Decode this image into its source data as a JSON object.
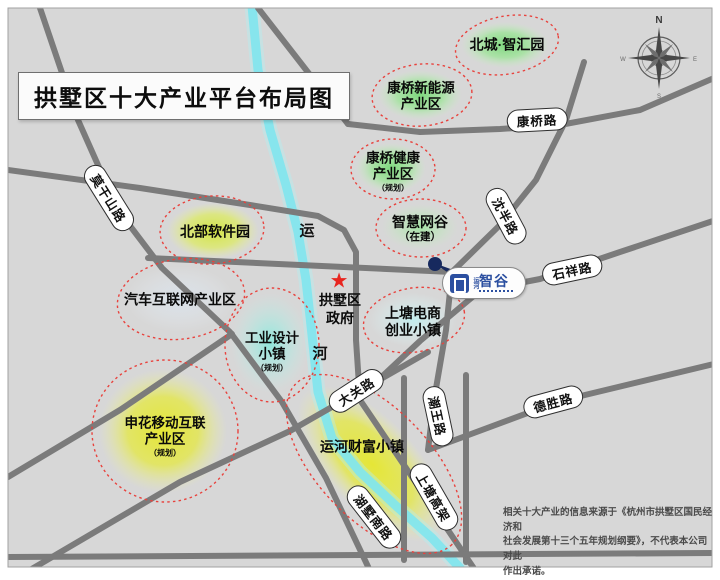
{
  "title": "拱墅区十大产业平台布局图",
  "zones": [
    {
      "id": "beicheng",
      "label": "北城·智汇园"
    },
    {
      "id": "kangqiao_energy",
      "line1": "康桥新能源",
      "line2": "产业区"
    },
    {
      "id": "kangqiao_health",
      "line1": "康桥健康",
      "line2": "产业区",
      "note": "（规划）"
    },
    {
      "id": "smart_valley",
      "line1": "智慧网谷",
      "note": "（在建）"
    },
    {
      "id": "north_software",
      "label": "北部软件园"
    },
    {
      "id": "auto_internet",
      "label": "汽车互联网产业区"
    },
    {
      "id": "industrial_design",
      "line1": "工业设计",
      "line2": "小镇",
      "note": "（规划）"
    },
    {
      "id": "shangtang_ec",
      "line1": "上塘电商",
      "line2": "创业小镇"
    },
    {
      "id": "shenhua",
      "line1": "申花移动互联",
      "line2": "产业区",
      "note": "（规划）"
    },
    {
      "id": "canal_wealth",
      "label": "运河财富小镇"
    }
  ],
  "roads": {
    "kangqiao": "康桥路",
    "moganshan": "莫干山路",
    "shenban": "沈半路",
    "shixiang": "石祥路",
    "desheng": "德胜路",
    "daguan": "大关路",
    "chaowang": "潮王路",
    "shangtang_viaduct": "上塘高架",
    "hushu_south": "湖墅南路"
  },
  "river": {
    "char1": "运",
    "char2": "河"
  },
  "government": {
    "star": "★",
    "line1": "拱墅区",
    "line2": "政府"
  },
  "logo": {
    "prefix": "运河",
    "name": "智谷"
  },
  "compass": {
    "n": "N",
    "e": "E",
    "s": "S",
    "w": "W"
  },
  "disclaimer": {
    "line1": "相关十大产业的信息来源于《杭州市拱墅区国民经济和",
    "line2": "社会发展第十三个五年规划纲要》，不代表本公司对此",
    "line3": "作出承诺。"
  },
  "colors": {
    "map_background": "#d7d7d7",
    "road_gray": "#7b7b7b",
    "river_cyan": "#7fe6ee",
    "ellipse_red": "#e8423d",
    "blob_green": "#7ad97a",
    "blob_yellow": "#e6e72e",
    "star_red": "#e8251f",
    "logo_blue": "#2b4fa0",
    "marker_navy": "#17295e"
  }
}
